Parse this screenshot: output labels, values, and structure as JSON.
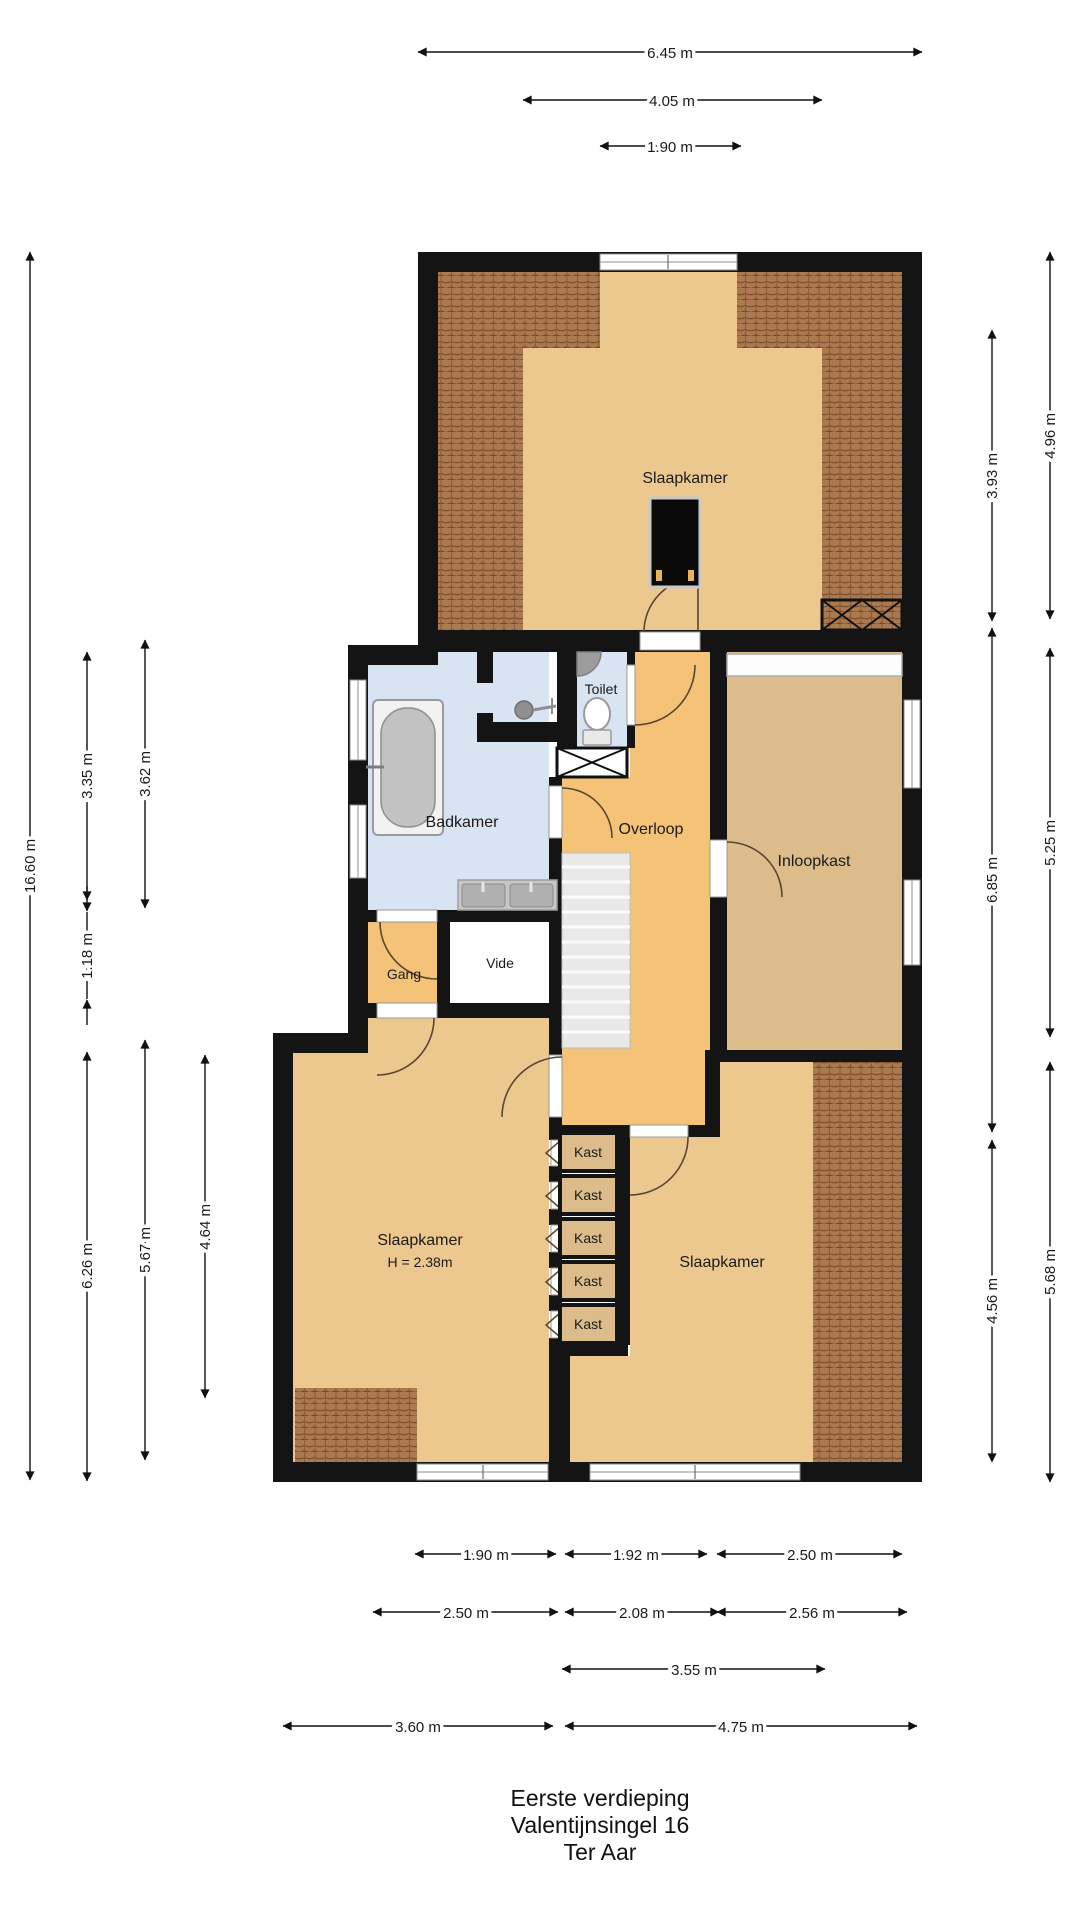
{
  "title": {
    "line1": "Eerste verdieping",
    "line2": "Valentijnsingel 16",
    "line3": "Ter Aar"
  },
  "rooms": {
    "bedroom_top": "Slaapkamer",
    "bathroom": "Badkamer",
    "toilet": "Toilet",
    "landing": "Overloop",
    "walk_in_closet": "Inloopkast",
    "hallway": "Gang",
    "void": "Vide",
    "bedroom_left": "Slaapkamer",
    "bedroom_left_height": "H = 2.38m",
    "bedroom_right": "Slaapkamer"
  },
  "closets": [
    "Kast",
    "Kast",
    "Kast",
    "Kast",
    "Kast"
  ],
  "dimensions": {
    "top": [
      {
        "label": "6.45 m"
      },
      {
        "label": "4.05 m"
      },
      {
        "label": "1.90 m"
      }
    ],
    "left": [
      {
        "label": "16.60 m"
      },
      {
        "label": "3.35 m"
      },
      {
        "label": "3.62 m"
      },
      {
        "label": "1.18 m"
      },
      {
        "label": "6.26 m"
      },
      {
        "label": "5.67 m"
      },
      {
        "label": "4.64 m"
      }
    ],
    "right": [
      {
        "label": "4.96 m"
      },
      {
        "label": "3.93 m"
      },
      {
        "label": "6.85 m"
      },
      {
        "label": "5.25 m"
      },
      {
        "label": "4.56 m"
      },
      {
        "label": "5.68 m"
      }
    ],
    "bottom_row1": [
      {
        "label": "1.90 m"
      },
      {
        "label": "1.92 m"
      },
      {
        "label": "2.50 m"
      }
    ],
    "bottom_row2": [
      {
        "label": "2.50 m"
      },
      {
        "label": "2.08 m"
      },
      {
        "label": "2.56 m"
      }
    ],
    "bottom_row3": [
      {
        "label": "3.55 m"
      }
    ],
    "bottom_row4": [
      {
        "label": "3.60 m"
      },
      {
        "label": "4.75 m"
      }
    ]
  },
  "colors": {
    "wall": "#141414",
    "bedroom_floor": "#edc88e",
    "landing_floor": "#f4c377",
    "closet_floor": "#dcbc8a",
    "bathroom_floor": "#d9e4f2",
    "roof_tile": "#aa7950",
    "roof_tile_line": "#6e4526",
    "stairs": "#e9e9e9",
    "void_floor": "#ffffff"
  }
}
